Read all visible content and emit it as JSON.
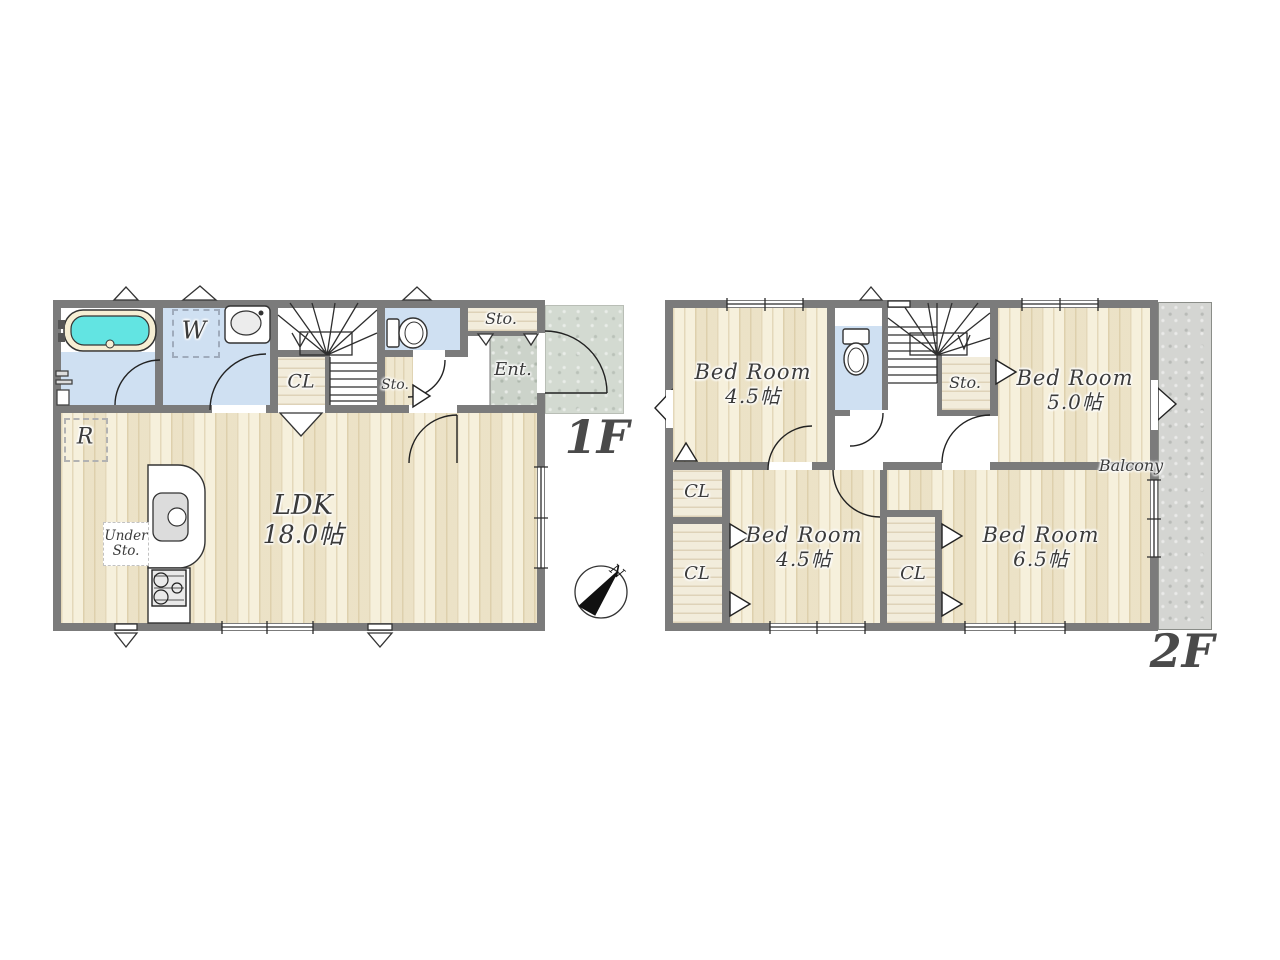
{
  "floor1": {
    "label": "1F",
    "ldk": {
      "name": "LDK",
      "size": "18.0帖"
    },
    "washroom": "W",
    "closet": "CL",
    "sto_under_stairs": "Sto.",
    "sto_hall": "Sto.",
    "entrance": "Ent.",
    "under_sto": [
      "Under",
      "Sto."
    ],
    "fridge": "R"
  },
  "floor2": {
    "label": "2F",
    "bedroom_nw": {
      "name": "Bed Room",
      "size": "4.5帖"
    },
    "bedroom_ne": {
      "name": "Bed Room",
      "size": "5.0帖"
    },
    "bedroom_sw": {
      "name": "Bed Room",
      "size": "4.5帖"
    },
    "bedroom_se": {
      "name": "Bed Room",
      "size": "6.5帖"
    },
    "storage": "Sto.",
    "closet_nw": "CL",
    "closet_sw": "CL",
    "closet_center": "CL",
    "balcony": "Balcony"
  },
  "compass": {
    "north": "N"
  },
  "colors": {
    "wall": "#7b7b7b",
    "wood_floor": "#f4ecd3",
    "wet_room_floor": "#cfe0f2",
    "bathtub_water": "#62e4e2",
    "entrance_stone": "#ccd3ca",
    "balcony": "#d4d5d2"
  }
}
